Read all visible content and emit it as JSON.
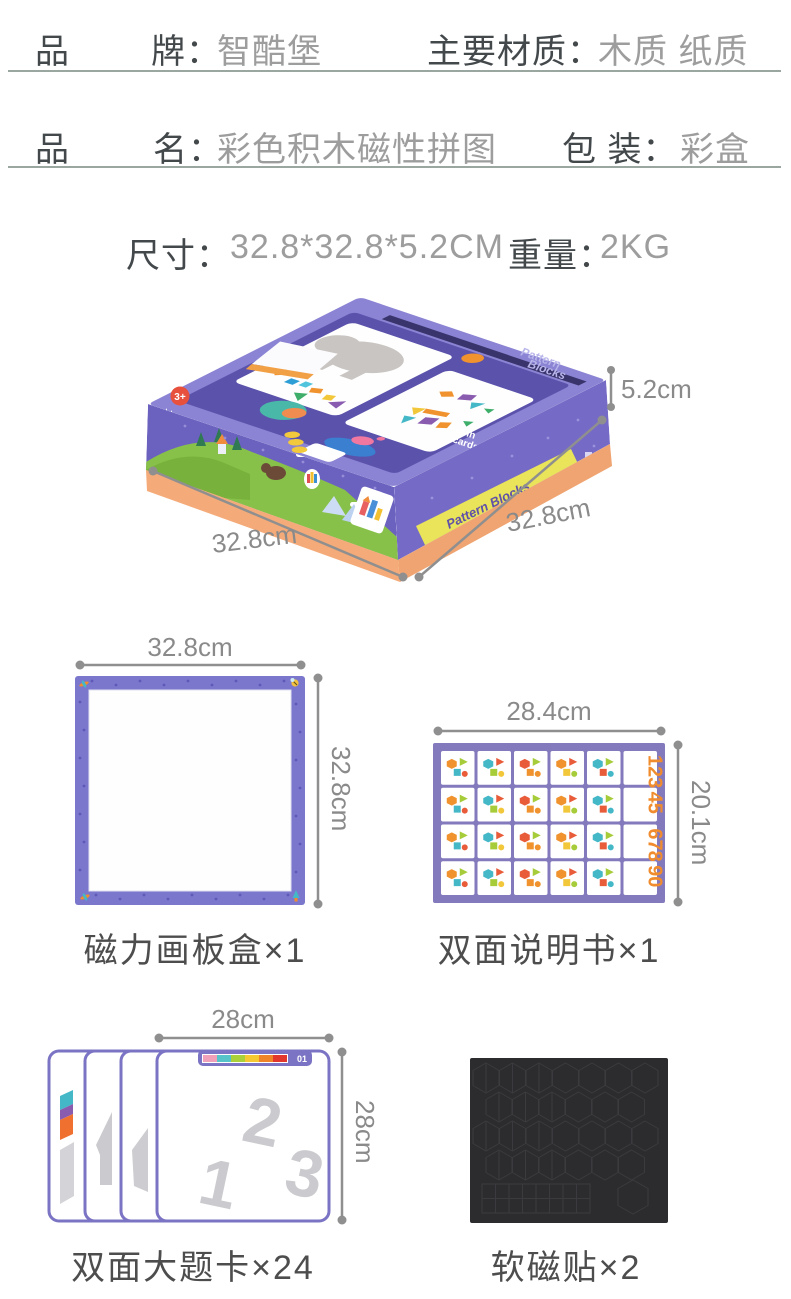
{
  "specs": {
    "brand_char1": "品",
    "brand_char2": "牌：",
    "brand_value": "智酷堡",
    "material_label": "主要材质：",
    "material_value": "木质 纸质",
    "name_char1": "品",
    "name_char2": "名：",
    "name_value": "彩色积木磁性拼图",
    "package_label": "包 装：",
    "package_value": "彩盒",
    "size_label": "尺寸：",
    "size_value": "32.8*32.8*5.2CM",
    "weight_label": "重量：",
    "weight_value": "2KG"
  },
  "box_figure": {
    "height_dim": "5.2cm",
    "left_dim": "32.8cm",
    "right_dim": "32.8cm",
    "side_banner": "Pattern Blocks",
    "lid_title_line1": "Pattern",
    "lid_title_line2": "Blocks",
    "lid_note_line1": "Put in",
    "lid_note_line2": "cards",
    "age_badge": "3+"
  },
  "board_figure": {
    "top_dim": "32.8cm",
    "right_dim": "32.8cm",
    "caption": "磁力画板盒×1"
  },
  "manual_figure": {
    "top_dim": "28.4cm",
    "right_dim": "20.1cm",
    "caption": "双面说明书×1",
    "number_cells": [
      "123",
      "45",
      "678",
      "90"
    ]
  },
  "cards_figure": {
    "top_dim": "28cm",
    "right_dim": "28cm",
    "caption": "双面大题卡×24",
    "card_index": "01",
    "ghost_numbers": [
      "1",
      "2",
      "3"
    ]
  },
  "magnet_figure": {
    "caption": "软磁贴×2"
  },
  "palette": {
    "shapes": [
      "#f0932e",
      "#a6cc3a",
      "#45b8c8",
      "#8a5cb0",
      "#e85c3a",
      "#f2c73a"
    ],
    "strip": [
      "#f0a0b8",
      "#56c4c8",
      "#aad03a",
      "#f6c832",
      "#f08428",
      "#e2372c"
    ],
    "number_color": "#f08c2e",
    "magnet_bg": "#2c2c2e",
    "magnet_line": "#3b3b3f"
  }
}
